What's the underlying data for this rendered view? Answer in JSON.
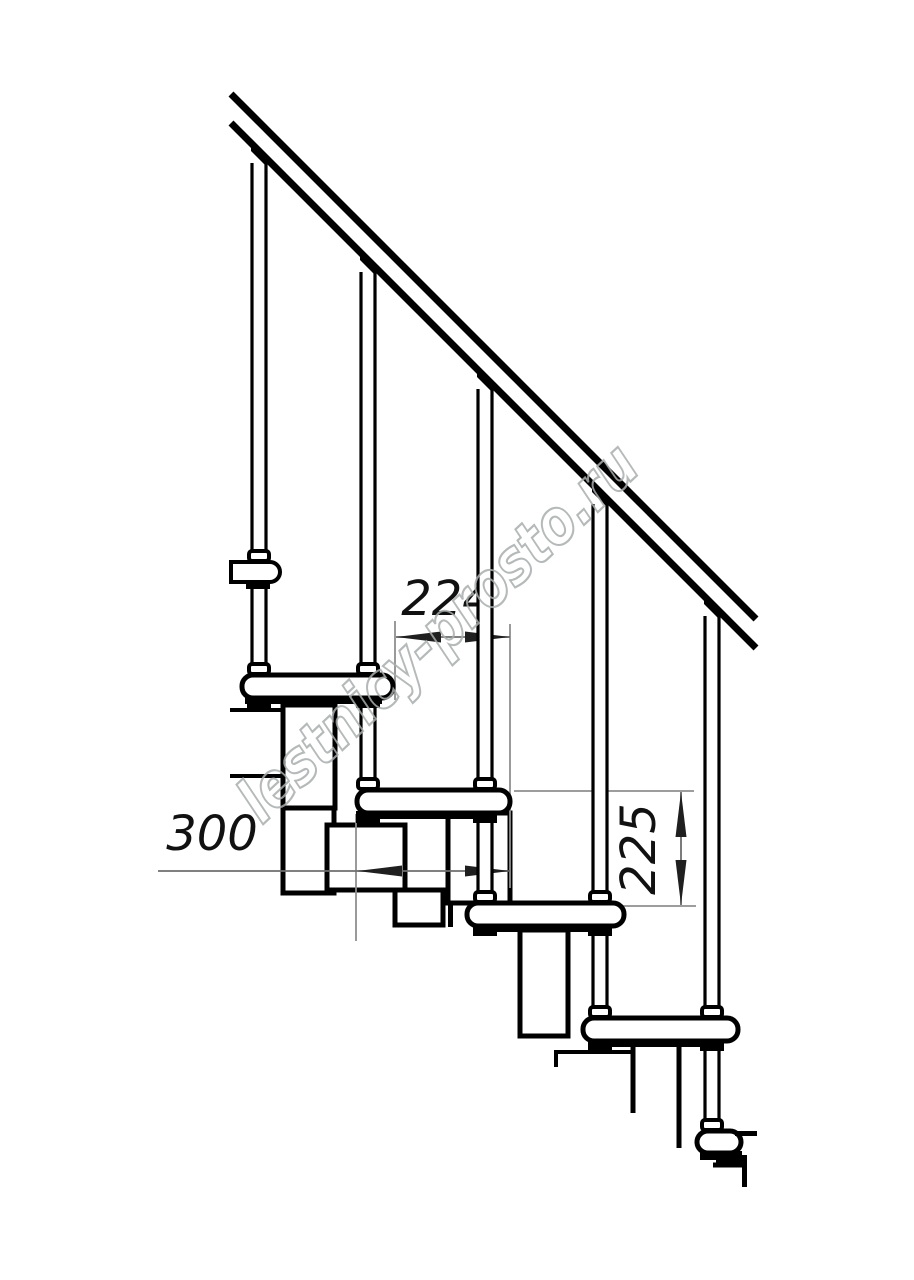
{
  "drawing": {
    "type": "modular staircase side-view technical drawing",
    "watermark": {
      "text": "lestnicy-prosto.ru"
    },
    "dimensions": {
      "going": {
        "label": "224",
        "orientation": "horizontal",
        "meaning": "step run between nosings, mm"
      },
      "depth": {
        "label": "300",
        "orientation": "horizontal",
        "meaning": "tread depth, mm"
      },
      "rise": {
        "label": "225",
        "orientation": "vertical",
        "meaning": "riser height, mm"
      }
    },
    "colors": {
      "line": "#000000",
      "dimension_line": "#6e6e6e",
      "extension_line": "#8f8f8f",
      "text": "#111111",
      "watermark": "#a8adad",
      "background": "#ffffff"
    }
  }
}
